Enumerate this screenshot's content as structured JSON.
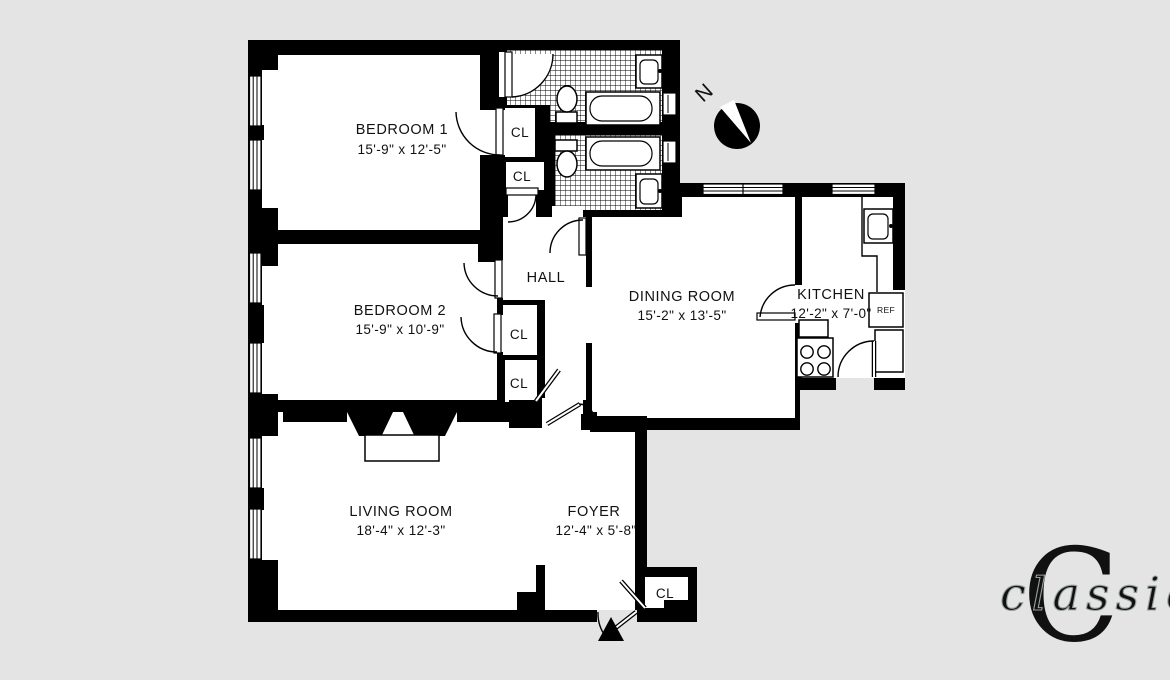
{
  "rooms": {
    "bedroom1": {
      "name": "BEDROOM 1",
      "dims": "15'-9\" x 12'-5\""
    },
    "bedroom2": {
      "name": "BEDROOM 2",
      "dims": "15'-9\" x 10'-9\""
    },
    "living": {
      "name": "LIVING ROOM",
      "dims": "18'-4\" x 12'-3\""
    },
    "foyer": {
      "name": "FOYER",
      "dims": "12'-4\" x 5'-8\""
    },
    "dining": {
      "name": "DINING ROOM",
      "dims": "15'-2\" x 13'-5\""
    },
    "kitchen": {
      "name": "KITCHEN",
      "dims": "12'-2\" x 7'-0\""
    },
    "hall": {
      "name": "HALL"
    }
  },
  "labels": {
    "closet": "CL",
    "refrigerator": "REF",
    "north": "N"
  },
  "logo": {
    "initial": "C",
    "wordmark": "classic",
    "green": "#4d7a5c",
    "wordmark_fill": "#e9e9e9",
    "wordmark_outline": "#97a09c"
  },
  "colors": {
    "background": "#e4e4e4",
    "walls": "#000000"
  }
}
